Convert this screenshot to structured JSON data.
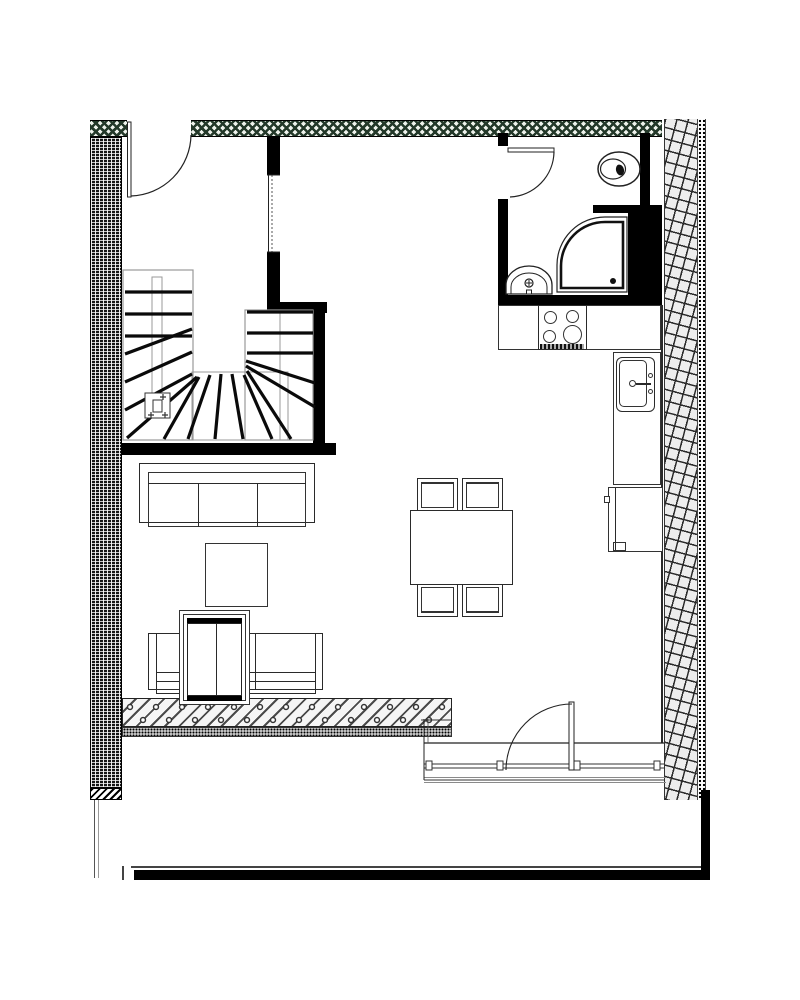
{
  "floor_plan": {
    "visible_text": [],
    "palette": {
      "wall": "#000000",
      "line": "#1a1a1a",
      "gray_line": "#8a8a8a",
      "hatch_fill": "#ededed",
      "speckle_green": "#24392a",
      "paper": "#ffffff"
    },
    "counts": {
      "dining_chairs": 4,
      "stove_burners": 4,
      "sofas": 2,
      "doors": 3
    },
    "fixture_labels": {
      "entry_door": "entry door",
      "hall_window": "interior window",
      "staircase": "u-shaped staircase",
      "stair_marker": "stair reference marker",
      "bathroom_door": "bathroom door",
      "toilet": "toilet",
      "shower": "corner shower",
      "washbasin": "washbasin",
      "kitchen_counter": "kitchen counter",
      "stove": "stove with 4 burners",
      "kitchen_sink": "kitchen sink",
      "fridge": "fridge unit",
      "dining_table": "dining table",
      "dining_chair": "dining chair",
      "sofa_large": "three-seat sofa",
      "sofa_small": "two-seat sofa",
      "coffee_table": "coffee table",
      "tv_cabinet": "cabinet",
      "balcony_door": "balcony door",
      "window_wall": "south window wall",
      "insulated_wall": "hatched exterior wall",
      "tiled_band": "tiled exterior band"
    }
  }
}
